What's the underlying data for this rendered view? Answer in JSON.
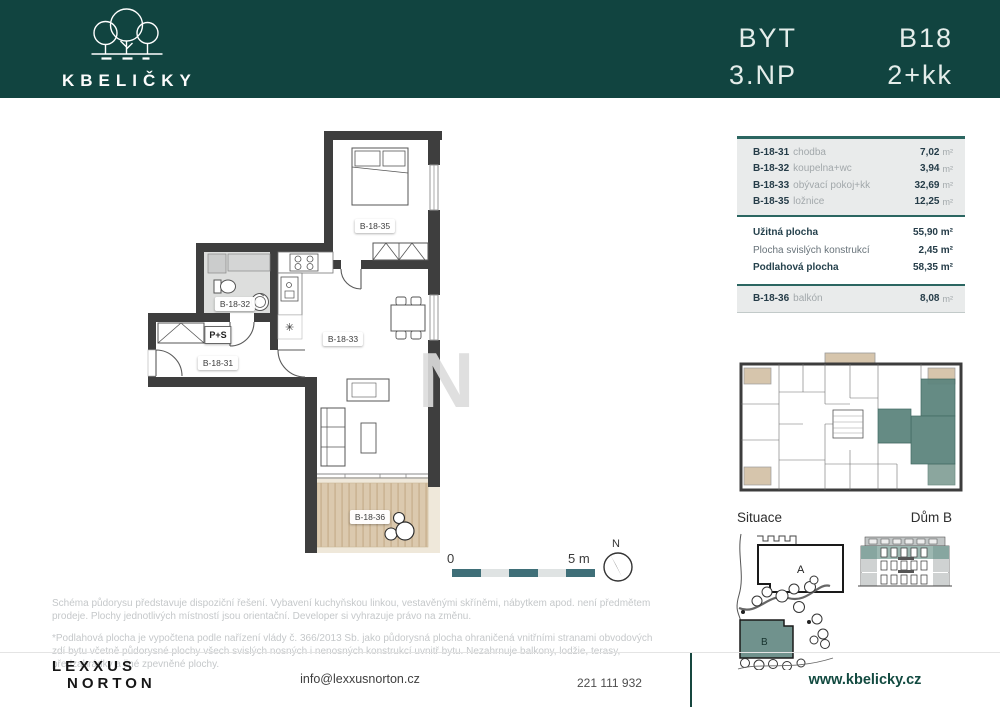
{
  "header": {
    "logo_text": "KBELIČKY",
    "byt_label": "BYT",
    "floor": "3.NP",
    "unit_id": "B18",
    "layout": "2+kk"
  },
  "plan": {
    "labels": {
      "hall": "B-18-31",
      "bath": "B-18-32",
      "living": "B-18-33",
      "bedroom": "B-18-35",
      "balcony": "B-18-36",
      "closet": "P+S",
      "kitchen_symbol": "✳",
      "watermark": "N"
    },
    "scale": {
      "start": "0",
      "end": "5 m"
    },
    "compass_n": "N"
  },
  "table": {
    "rooms": [
      {
        "code": "B-18-31",
        "name": "chodba",
        "value": "7,02",
        "unit": "m²"
      },
      {
        "code": "B-18-32",
        "name": "koupelna+wc",
        "value": "3,94",
        "unit": "m²"
      },
      {
        "code": "B-18-33",
        "name": "obývací pokoj+kk",
        "value": "32,69",
        "unit": "m²"
      },
      {
        "code": "B-18-35",
        "name": "ložnice",
        "value": "12,25",
        "unit": "m²"
      }
    ],
    "summary": [
      {
        "label": "Užitná plocha",
        "value": "55,90 m²"
      },
      {
        "label": "Plocha svislých konstrukcí",
        "value": "2,45 m²"
      },
      {
        "label": "Podlahová plocha",
        "value": "58,35 m²"
      }
    ],
    "extra": {
      "code": "B-18-36",
      "name": "balkón",
      "value": "8,08",
      "unit": "m²"
    }
  },
  "situace": {
    "title": "Situace",
    "building_a": "A",
    "building_b": "B"
  },
  "dum": {
    "title": "Dům B"
  },
  "notes": {
    "p1": "Schéma půdorysu představuje dispoziční řešení. Vybavení kuchyňskou linkou, vestavěnými skříněmi, nábytkem apod. není předmětem prodeje. Plochy jednotlivých místností jsou orientační. Developer si vyhrazuje právo na změnu.",
    "p2": "*Podlahová plocha je vypočtena podle nařízení vlády č. 366/2013 Sb. jako půdorysná plocha ohraničená vnitřními stranami obvodových zdí bytu včetně půdorysné plochy všech svislých nosných i nenosných konstrukcí uvnitř bytu. Nezahrnuje balkony, lodžie, terasy, předzahrádky a jiné zpevněné plochy."
  },
  "footer": {
    "brand_line1": "LEXXUS",
    "brand_line2": "NORTON",
    "email": "info@lexxusnorton.cz",
    "phone": "221 111 932",
    "website": "www.kbelicky.cz"
  },
  "colors": {
    "header_green": "#114440",
    "table_teal": "#2b6661",
    "highlight_teal": "#5d857e",
    "balcony_wood": "#dbc9ae",
    "scale_teal": "#3f6f78",
    "website_green": "#124a40"
  }
}
